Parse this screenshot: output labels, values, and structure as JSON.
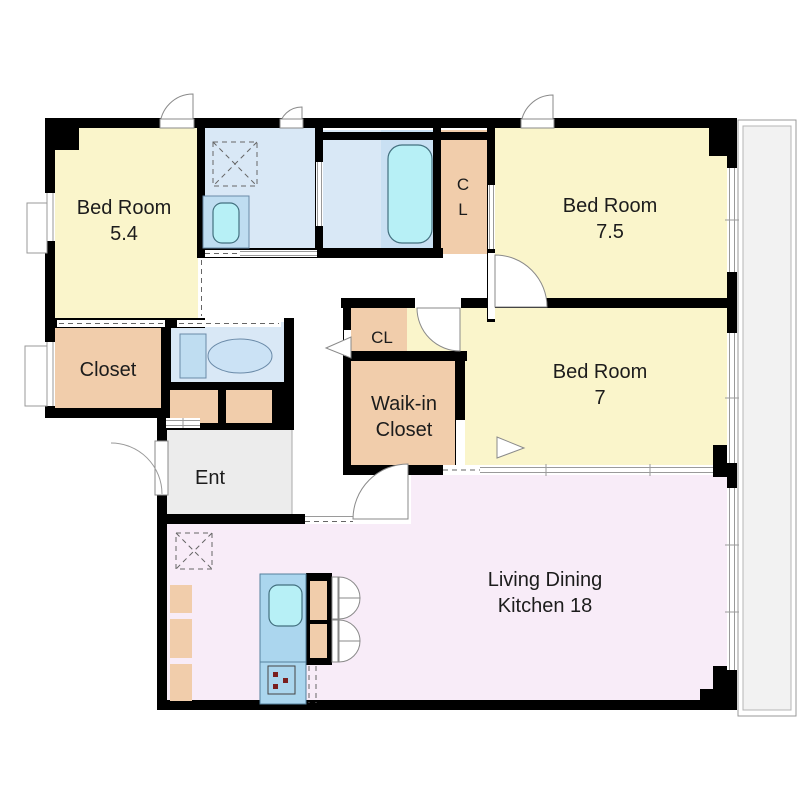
{
  "plan": {
    "rooms": {
      "bedroom_5_4": {
        "name": "Bed Room",
        "size": "5.4"
      },
      "bedroom_7_5": {
        "name": "Bed Room",
        "size": "7.5"
      },
      "bedroom_7": {
        "name": "Bed Room",
        "size": "7"
      },
      "closet_upper": {
        "letter1": "C",
        "letter2": "L"
      },
      "closet_left": {
        "name": "Closet"
      },
      "closet_small": {
        "name": "CL"
      },
      "walk_in_closet": {
        "line1": "Waik-in",
        "line2": "Closet"
      },
      "entrance": {
        "name": "Ent"
      },
      "living_dining_kitchen": {
        "line1": "Living Dining",
        "line2": "Kitchen 18"
      }
    },
    "colors": {
      "room_yellow": "#FAF5CB",
      "room_pink": "#F8ECF8",
      "sanitary_blue": "#D9E8F6",
      "bath_blue": "#C9E0F3",
      "closet_tan": "#F1CDAB",
      "entry_gray": "#ECECEC",
      "balcony_gray": "#F2F2F2",
      "fixture_cyan": "#B7F0F6",
      "wall_black": "#000000"
    },
    "fixtures": [
      "washing-machine-space",
      "vanity-sink",
      "bathtub",
      "toilet",
      "shoe-cabinet",
      "refrigerator-space",
      "kitchen-counter",
      "kitchen-sink",
      "stove",
      "storage-shelf",
      "balcony",
      "entrance-door",
      "hinged-doors",
      "sliding-doors",
      "windows"
    ]
  }
}
